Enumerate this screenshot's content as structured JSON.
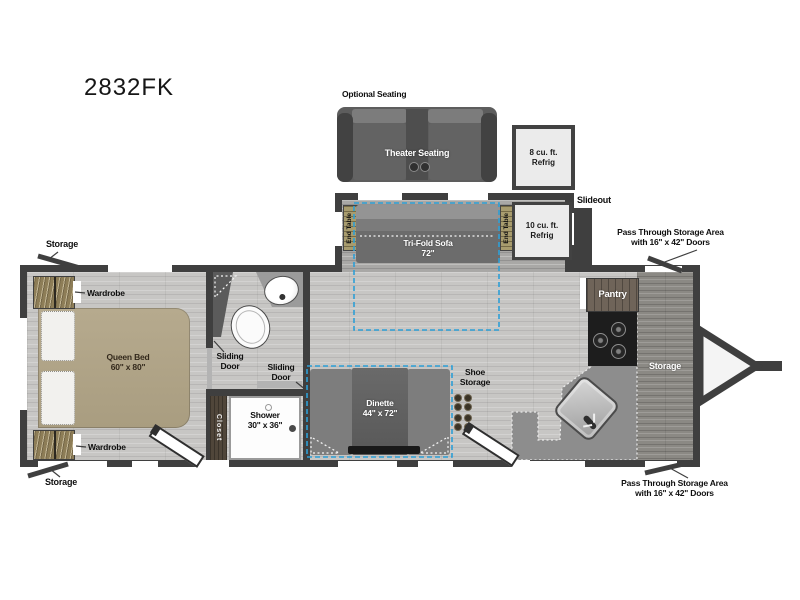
{
  "title": "2832FK",
  "colors": {
    "wall": "#3f3f3f",
    "slide_dash": "#2d9fd6",
    "bed": "#b2a68a",
    "wood_accent": "#a89c6e",
    "counter": "#8d8d8d",
    "floor_light": "#c7c6c4",
    "floor_storage": "#8b8984"
  },
  "optional": {
    "heading": "Optional Seating",
    "theater_label": "Theater Seating",
    "refrig8_label": "8 cu. ft.\nRefrig"
  },
  "slideout": {
    "tag": "Slideout",
    "sofa_label": "Tri-Fold Sofa\n72\"",
    "end_table_left": "End Table",
    "end_table_right": "End Table",
    "refrig10_label": "10 cu. ft.\nRefrig"
  },
  "bedroom": {
    "bed_label": "Queen Bed\n60\" x 80\"",
    "wardrobe_top": "Wardrobe",
    "wardrobe_bottom": "Wardrobe",
    "storage_top": "Storage",
    "storage_bottom": "Storage"
  },
  "bath": {
    "sliding_door_left": "Sliding\nDoor",
    "sliding_door_right": "Sliding\nDoor",
    "closet": "Closet",
    "shower": "Shower\n30\" x 36\""
  },
  "living": {
    "dinette": "Dinette\n44\" x 72\"",
    "shoe_storage": "Shoe\nStorage"
  },
  "kitchen": {
    "pantry": "Pantry",
    "front_storage": "Storage"
  },
  "callouts": {
    "pass_through_top": "Pass Through Storage Area\nwith 16\" x 42\" Doors",
    "pass_through_bottom": "Pass Through Storage Area\nwith 16\" x 42\" Doors"
  }
}
